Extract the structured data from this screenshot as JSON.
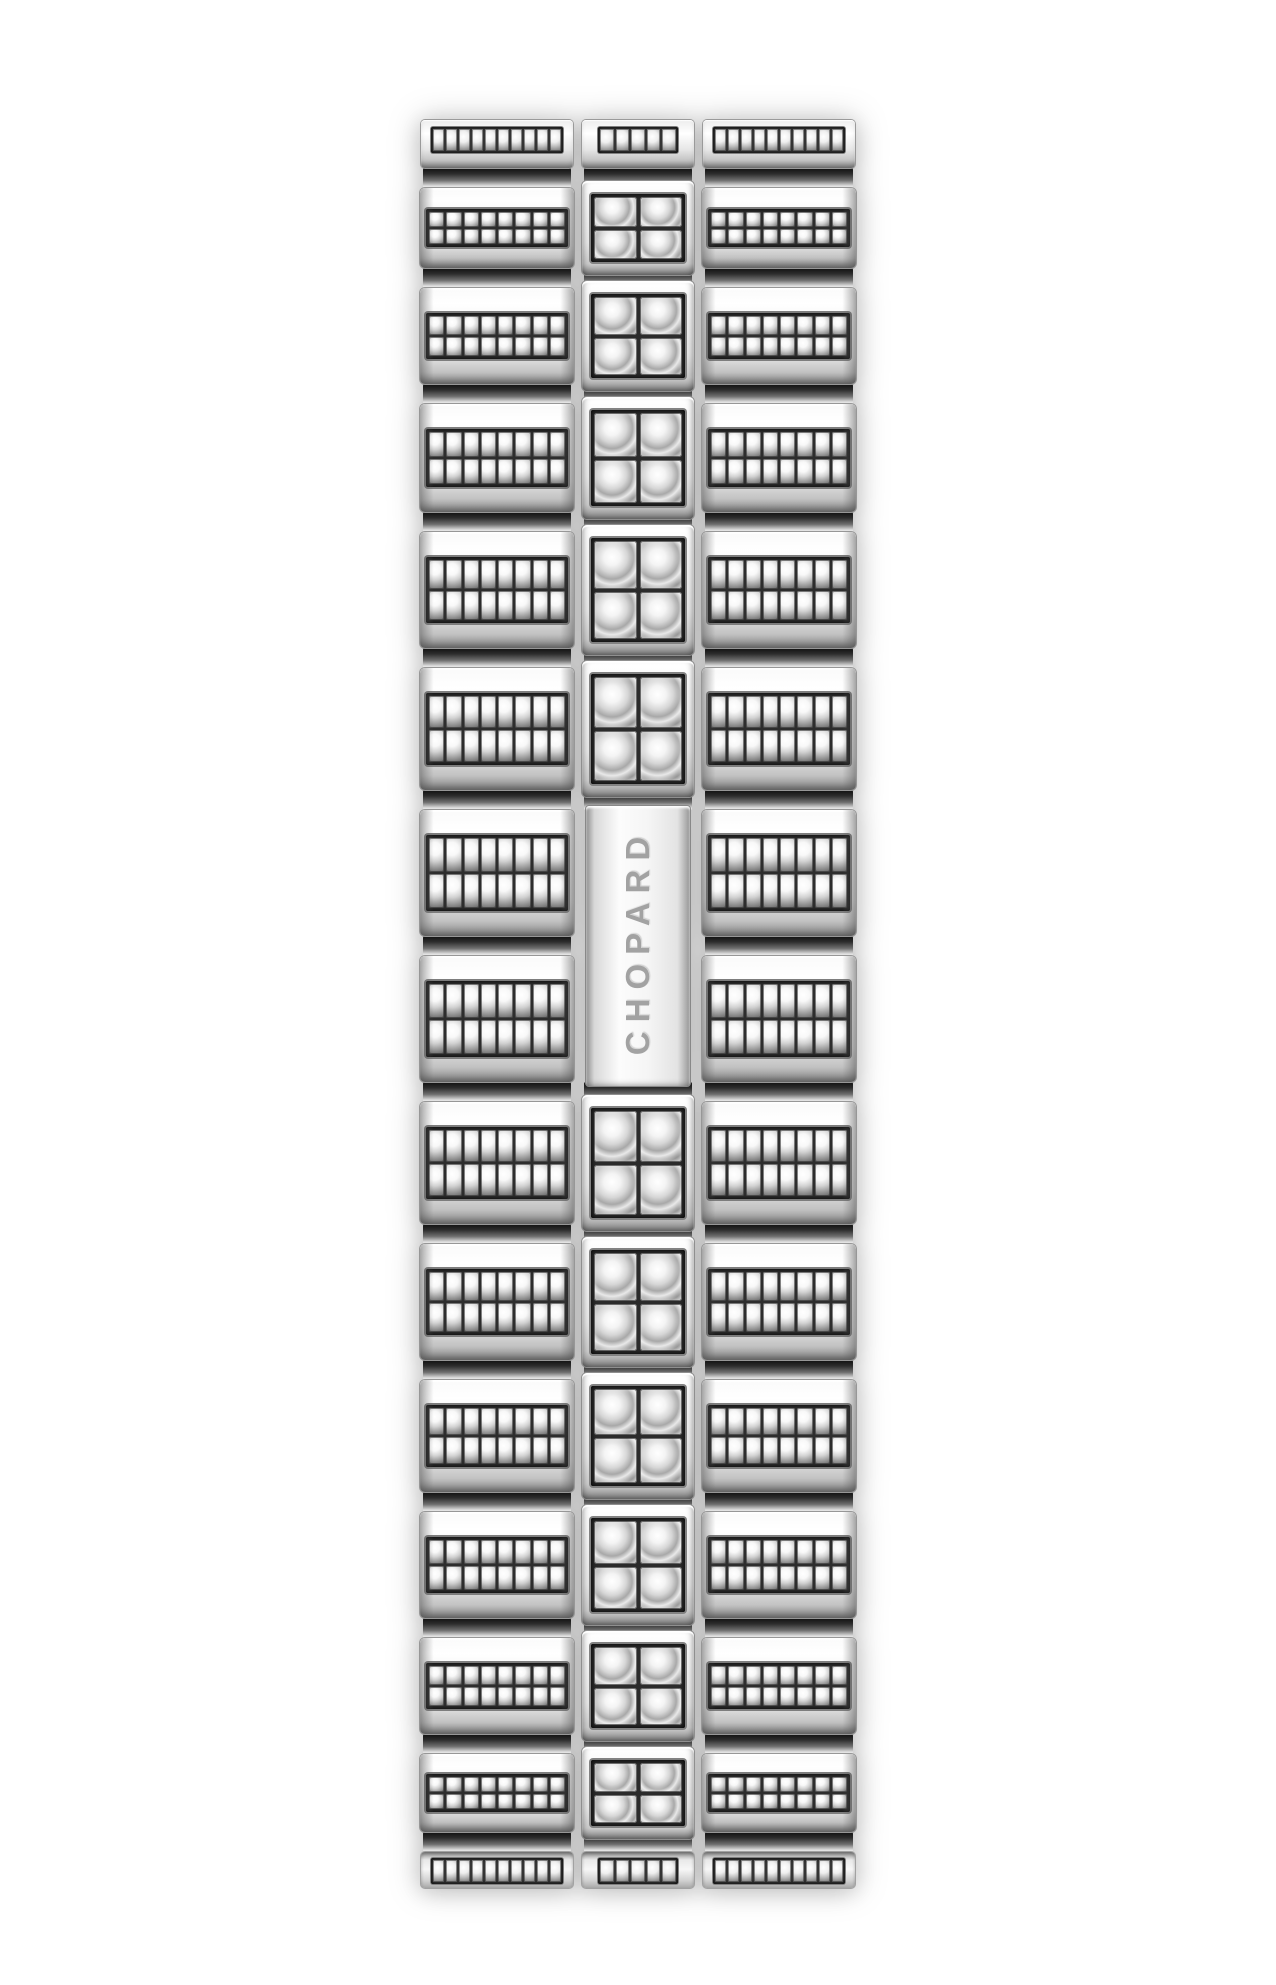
{
  "image": {
    "type": "product-photo",
    "subject": "diamond-pave watch bracelet with folding clasp",
    "background_color": "#ffffff"
  },
  "brand": {
    "name": "CHOPARD"
  },
  "bracelet": {
    "clasp": {
      "engraving": "CHOPARD",
      "text_orientation": "vertical, reads bottom-to-top"
    },
    "layout": {
      "left": 420,
      "top": 120,
      "width": 436,
      "row_heights": [
        80,
        96,
        108,
        116,
        122,
        126,
        126,
        122,
        116,
        112,
        106,
        96,
        78
      ],
      "clasp_row_indices": [
        5,
        6
      ],
      "seam_height": 20,
      "top_cap_height": 48,
      "bottom_cap_height": 36,
      "column_widths": {
        "left": 154,
        "center": 114,
        "right": 154
      },
      "column_gap": 7
    },
    "links": {
      "side_link_stone_rows": 2,
      "side_link_stone_cols": 8,
      "stones_per_side_link": 16,
      "cube_stone_rows": 2,
      "cube_stone_cols": 2,
      "stones_per_cube": 4,
      "cap_side_stones": 10,
      "cap_center_stones": 5
    },
    "counts": {
      "side_link_rows": 13,
      "center_cube_links": 11,
      "end_caps": 2
    },
    "colors": {
      "metal_bright": "#ffffff",
      "metal_light": "#f2f2f2",
      "metal_mid": "#d9d9d9",
      "metal_dark": "#8f8f8f",
      "seam_shadow": "#101010",
      "pave_bed": "#2d2d2d",
      "stone_core": "#ffffff",
      "stone_rim": "#6f6f6f",
      "engraving_gray": "#a2a2a2"
    }
  }
}
